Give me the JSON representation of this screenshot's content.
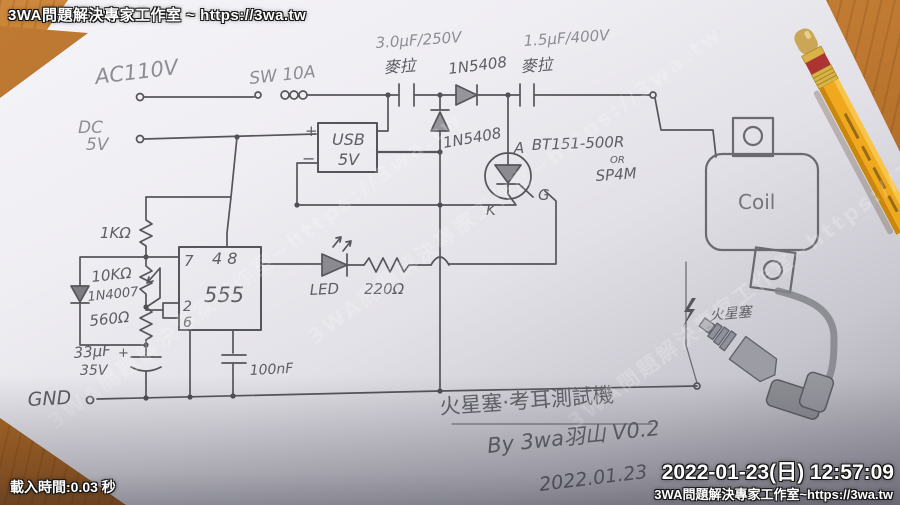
{
  "overlays": {
    "watermark_top_left": "3WA問題解決專家工作室 ~ https://3wa.tw",
    "load_time": "載入時間:0.03 秒",
    "timestamp": "2022-01-23(日) 12:57:09",
    "watermark_bottom_right": "3WA問題解決專家工作室~https://3wa.tw",
    "diagonal": "3WA問題解決專家工作室~https://3wa.tw"
  },
  "schematic": {
    "power": {
      "ac": "AC110V",
      "sw": "SW 10A",
      "dc": "DC",
      "dc_v": "5V"
    },
    "caps": {
      "c1": "3.0μF/250V",
      "c1_type": "麥拉",
      "c2": "1.5μF/400V",
      "c2_type": "麥拉",
      "c3": "33μF",
      "c3_v": "35V",
      "c3_plus": "+",
      "c4": "100nF"
    },
    "diodes": {
      "d1": "1N5408",
      "d2": "1N5408",
      "d3": "1N4007"
    },
    "resistors": {
      "r1": "1KΩ",
      "r2": "10KΩ",
      "r3": "560Ω",
      "r4": "220Ω"
    },
    "usb": {
      "name": "USB",
      "v": "5V",
      "plus": "+",
      "minus": "−"
    },
    "timer": {
      "ic": "555",
      "pin7": "7",
      "pin48": "4 8",
      "pin2": "2",
      "pin6": "6"
    },
    "scr": {
      "part": "BT151-500R",
      "or": "OR",
      "alt": "SP4M",
      "a": "A",
      "k": "K",
      "g": "G"
    },
    "led": "LED",
    "gnd": "GND",
    "coil": "Coil",
    "spark_plug": "火星塞"
  },
  "footer": {
    "title": "火星塞·考耳測試機",
    "byline": "By 3wa羽山 V0.2",
    "date": "2022.01.23"
  },
  "colors": {
    "pencil": "#55555b",
    "pencil_light": "#8d8d95",
    "wood": "#b4702a",
    "paper": "#eceaf0",
    "pencil_body": "#f0a81f",
    "pencil_ring": "#ae3434"
  }
}
